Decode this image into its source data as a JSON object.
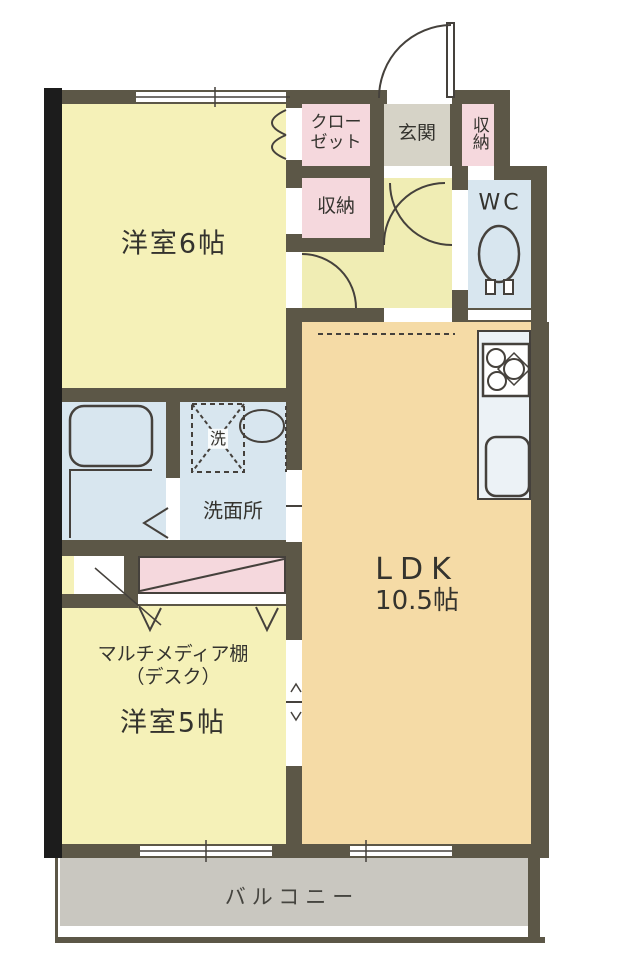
{
  "plan": {
    "rooms": {
      "bedroom6": "洋室6帖",
      "closet_l1": "クロー",
      "closet_l2": "ゼット",
      "entrance": "玄関",
      "storage_top": "収納",
      "storage_mid": "収納",
      "wc": "WC",
      "washer": "洗",
      "washroom": "洗面所",
      "ldk_l1": "LDK",
      "ldk_l2": "10.5帖",
      "desk_l1": "マルチメディア棚",
      "desk_l2": "（デスク）",
      "bedroom5": "洋室5帖",
      "balcony": "バルコニー"
    },
    "colors": {
      "wall": "#5c5747",
      "outer-wall": "#1c1c1c",
      "room-yellow": "#f5f1b8",
      "hall-yellow": "#f0edb4",
      "pink": "#f5d8dd",
      "entrance-gray": "#d6d3c7",
      "water-blue": "#d8e6ef",
      "ldk-peach": "#f5dba6",
      "kitchen-white": "#ecf2f6",
      "balcony-gray": "#c9c7c0",
      "line": "#45413c",
      "text": "#34332e"
    }
  }
}
